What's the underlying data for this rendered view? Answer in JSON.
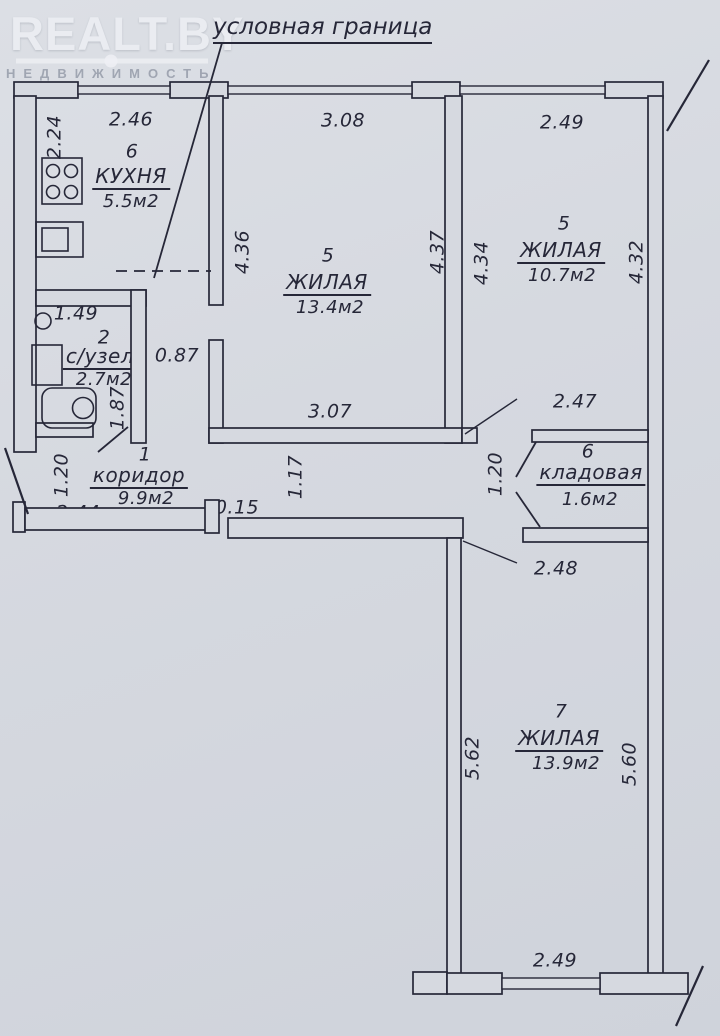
{
  "colors": {
    "paper": "#d6d9e0",
    "ink": "#262738",
    "watermark": "#eef0f4",
    "watermark_sub": "#9aa0ad"
  },
  "watermark": {
    "brand": "REALT.BY",
    "subtitle": "НЕДВИЖИМОСТЬ"
  },
  "annotation": {
    "boundary_label": "условная граница"
  },
  "fixtures": {
    "stove": "stove-icon",
    "sink": "sink-icon",
    "washbasin": "washbasin-icon",
    "washing_machine": "washing-machine-icon",
    "bathtub": "bathtub-icon"
  },
  "rooms": {
    "kitchen": {
      "number": "6",
      "name": "КУХНЯ",
      "area": "5.5м2",
      "dim_top": "2.46",
      "dim_left": "2.24"
    },
    "living_a": {
      "number": "5",
      "name": "ЖИЛАЯ",
      "area": "13.4м2",
      "dim_top": "3.08",
      "dim_left": "4.36",
      "dim_right": "4.37",
      "dim_bottom": "3.07"
    },
    "living_b": {
      "number": "5",
      "name": "ЖИЛАЯ",
      "area": "10.7м2",
      "dim_top": "2.49",
      "dim_left": "4.34",
      "dim_right": "4.32"
    },
    "bathroom": {
      "number": "2",
      "name": "с/узел",
      "area": "2.7м2",
      "dim_top": "1.49",
      "dim_side": "1.87",
      "dim_passage": "0.87"
    },
    "corridor": {
      "number": "1",
      "name": "коридор",
      "area": "9.9м2",
      "dim_side": "1.20",
      "dim_bottom": "2.44",
      "dim_step": "0.15",
      "dim_mid": "1.17"
    },
    "storage": {
      "number": "6",
      "name": "кладовая",
      "area": "1.6м2",
      "dim_top": "2.47",
      "dim_side": "1.20"
    },
    "living_c": {
      "number": "7",
      "name": "ЖИЛАЯ",
      "area": "13.9м2",
      "dim_top": "2.48",
      "dim_left": "5.62",
      "dim_right": "5.60",
      "dim_bottom": "2.49"
    }
  }
}
